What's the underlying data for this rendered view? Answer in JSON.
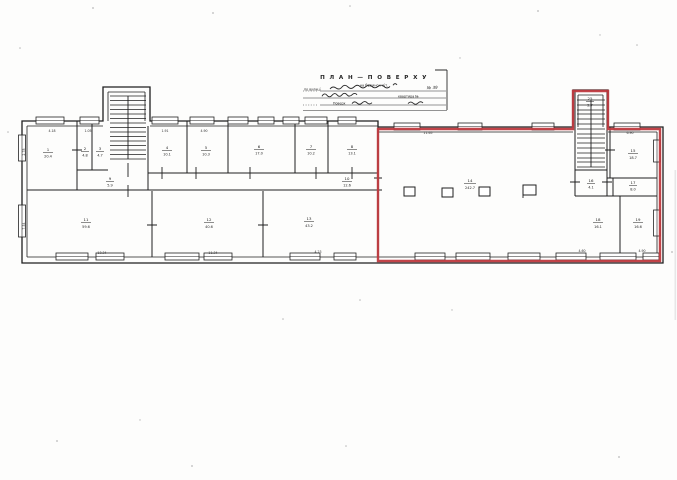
{
  "title_block": {
    "title": "П Л А Н — П О В Е Р Х У",
    "building_row": "на будинок літ.",
    "street_label": "по вулиці",
    "street_no": "№ 39",
    "flat_label": "квартира №",
    "floor_label": "Поверх"
  },
  "colors": {
    "ink": "#1f1f1f",
    "highlight": "#bf3a3f"
  },
  "rooms": [
    {
      "name": "room-1",
      "num": "1",
      "area": "20.4"
    },
    {
      "name": "room-2",
      "num": "2",
      "area": "4.8"
    },
    {
      "name": "room-3",
      "num": "3",
      "area": "4.7"
    },
    {
      "name": "room-4",
      "num": "4",
      "area": "10.1"
    },
    {
      "name": "room-5",
      "num": "5",
      "area": "10.3"
    },
    {
      "name": "room-6",
      "num": "6",
      "area": "17.0"
    },
    {
      "name": "room-7",
      "num": "7",
      "area": "10.2"
    },
    {
      "name": "room-8",
      "num": "8",
      "area": "13.1"
    },
    {
      "name": "lobby-left",
      "num": "9",
      "area": "5.9"
    },
    {
      "name": "corridor",
      "num": "10",
      "area": "12.6"
    },
    {
      "name": "room-11",
      "num": "11",
      "area": "59.6"
    },
    {
      "name": "room-12",
      "num": "12",
      "area": "40.6"
    },
    {
      "name": "room-13",
      "num": "13",
      "area": "43.2"
    },
    {
      "name": "hall",
      "num": "14",
      "area": "242.7"
    },
    {
      "name": "stair-landing",
      "num": "25",
      "area": "2.7"
    },
    {
      "name": "room-top-right",
      "num": "15",
      "area": "18.7"
    },
    {
      "name": "lobby-right",
      "num": "16",
      "area": "4.1"
    },
    {
      "name": "room-small-right",
      "num": "17",
      "area": "8.0"
    },
    {
      "name": "room-bottom-right-1",
      "num": "18",
      "area": "16.1"
    },
    {
      "name": "room-bottom-right-2",
      "num": "19",
      "area": "16.6"
    }
  ],
  "dimensions": [
    "4.18",
    "1.05",
    "1.91",
    "4.90",
    "2.78",
    "7.54",
    "13.34",
    "11.34",
    "4.23",
    "11.65",
    "6.90",
    "4.60",
    "4.90"
  ]
}
